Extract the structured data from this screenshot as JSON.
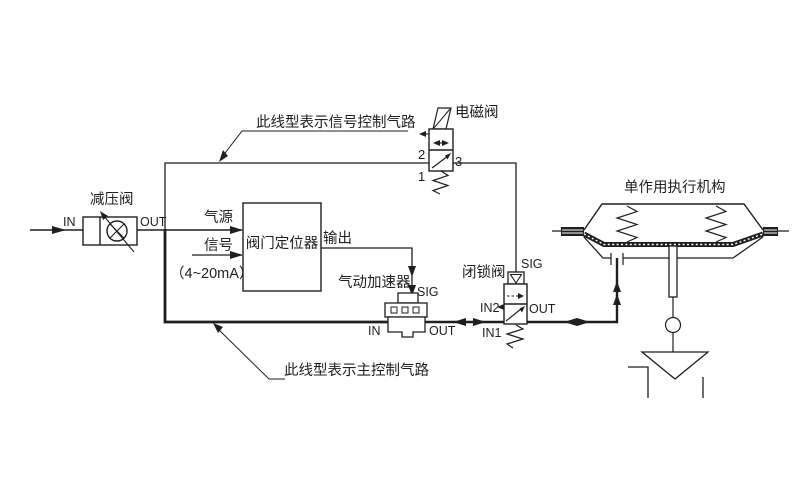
{
  "colors": {
    "background": "#ffffff",
    "ink": "#1f1f1f"
  },
  "legend": {
    "signal_line": "此线型表示信号控制气路",
    "main_line": "此线型表示主控制气路"
  },
  "components": {
    "pressure_reducing_valve": {
      "name": "减压阀",
      "port_in": "IN",
      "port_out": "OUT"
    },
    "positioner": {
      "name": "阀门定位器",
      "supply_label": "气源",
      "signal_label": "信号",
      "signal_range": "（4~20mA）",
      "output_label": "输出"
    },
    "solenoid_valve": {
      "name": "电磁阀",
      "port_1": "1",
      "port_2": "2",
      "port_3": "3"
    },
    "booster": {
      "name": "气动加速器",
      "port_sig": "SIG",
      "port_in": "IN",
      "port_out": "OUT"
    },
    "lockup_valve": {
      "name": "闭锁阀",
      "port_sig": "SIG",
      "port_in1": "IN1",
      "port_in2": "IN2",
      "port_out": "OUT"
    },
    "actuator": {
      "name": "单作用执行机构"
    }
  }
}
